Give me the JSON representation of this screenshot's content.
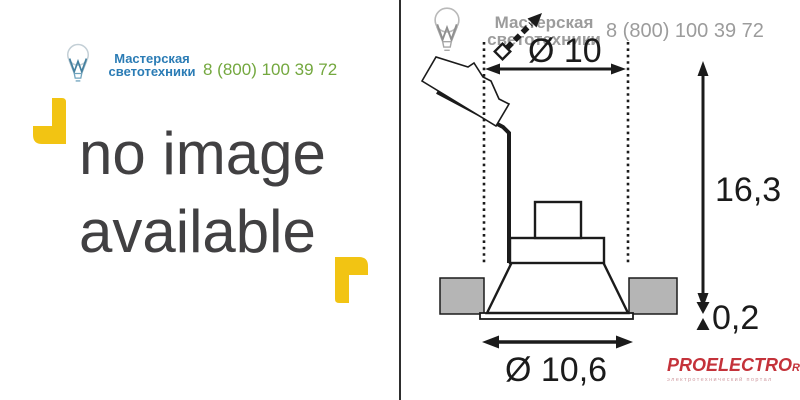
{
  "brand": {
    "name_line1": "Мастерская",
    "name_line2": "светотехники",
    "phone": "8 (800) 100 39 72"
  },
  "placeholder": {
    "line1": "no image",
    "line2": "available"
  },
  "drawing": {
    "dim_top_diameter": "Ø 10",
    "dim_height": "16,3",
    "dim_flange_thickness": "0,2",
    "dim_bottom_diameter": "Ø 10,6"
  },
  "footer_logo": {
    "title": "PROELECTRO",
    "tld": "RU",
    "tagline": "электротехнический портал"
  },
  "colors": {
    "brand_blue": "#2b7cb5",
    "phone_green": "#74a83f",
    "watermark_gray": "#9c9c9c",
    "accent_yellow": "#f2c413",
    "placeholder_gray": "#414042",
    "drawing_line": "#1b1b1b",
    "ceiling_fill": "#b5b5b5",
    "logo_red": "#c4323a"
  },
  "icons": {
    "brand_logo": "lightbulb-icon",
    "corner_marker": "corner-bracket-icon",
    "tilt_indicator": "tilt-arrow-icon"
  }
}
